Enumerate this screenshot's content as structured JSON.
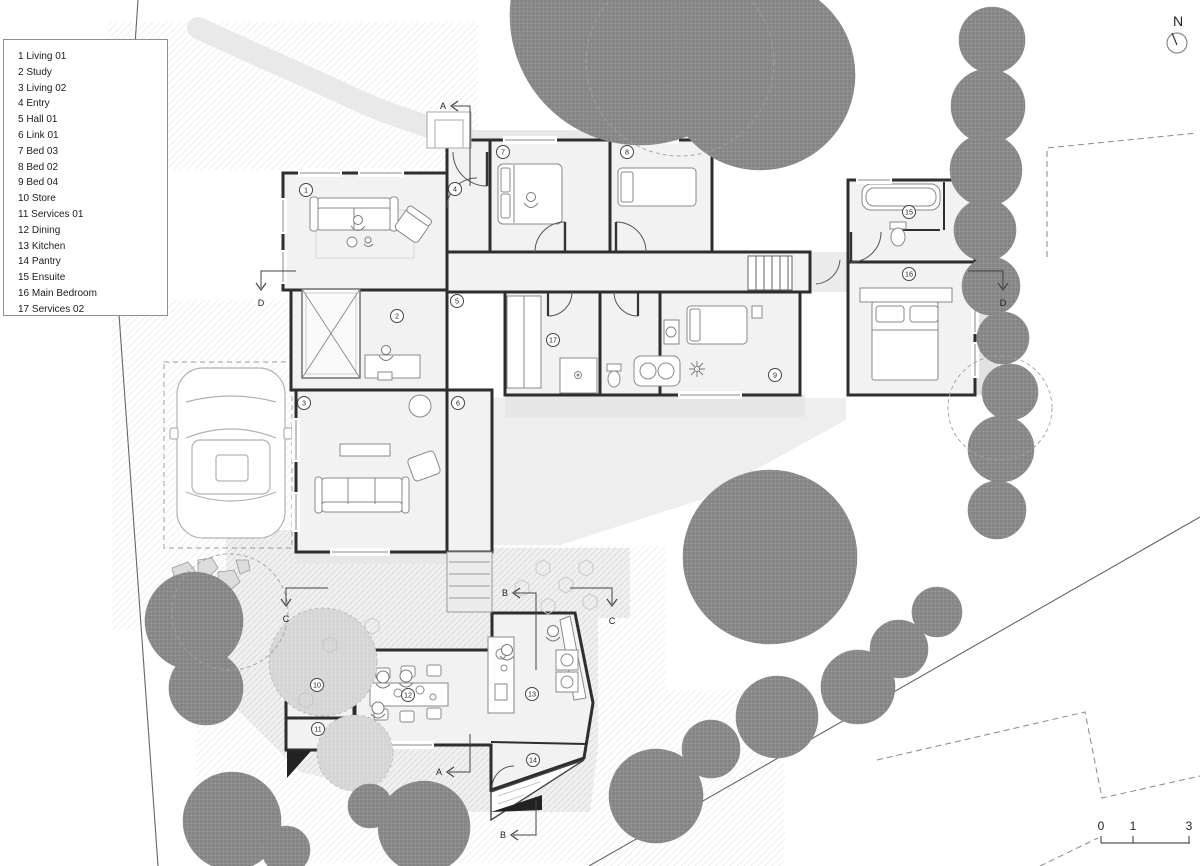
{
  "title": "Site and floor plan",
  "legend": {
    "items": [
      {
        "num": "1",
        "label": "Living 01"
      },
      {
        "num": "2",
        "label": "Study"
      },
      {
        "num": "3",
        "label": "Living 02"
      },
      {
        "num": "4",
        "label": "Entry"
      },
      {
        "num": "5",
        "label": "Hall 01"
      },
      {
        "num": "6",
        "label": "Link 01"
      },
      {
        "num": "7",
        "label": "Bed 03"
      },
      {
        "num": "8",
        "label": "Bed 02"
      },
      {
        "num": "9",
        "label": "Bed 04"
      },
      {
        "num": "10",
        "label": "Store"
      },
      {
        "num": "11",
        "label": "Services 01"
      },
      {
        "num": "12",
        "label": "Dining"
      },
      {
        "num": "13",
        "label": "Kitchen"
      },
      {
        "num": "14",
        "label": "Pantry"
      },
      {
        "num": "15",
        "label": "Ensuite"
      },
      {
        "num": "16",
        "label": "Main Bedroom"
      },
      {
        "num": "17",
        "label": "Services 02"
      }
    ]
  },
  "north": {
    "label": "N"
  },
  "scale_bar": {
    "y_line": 843,
    "x_start": 1101,
    "x_end": 1190,
    "ticks": [
      {
        "label": "0",
        "x": 1101
      },
      {
        "label": "1",
        "x": 1133
      },
      {
        "label": "3",
        "x": 1189
      }
    ]
  },
  "plan": {
    "rooms": [
      {
        "num": "1",
        "x": 306,
        "y": 190
      },
      {
        "num": "2",
        "x": 397,
        "y": 316
      },
      {
        "num": "3",
        "x": 304,
        "y": 403
      },
      {
        "num": "4",
        "x": 455,
        "y": 189
      },
      {
        "num": "5",
        "x": 457,
        "y": 301
      },
      {
        "num": "6",
        "x": 458,
        "y": 403
      },
      {
        "num": "7",
        "x": 503,
        "y": 152
      },
      {
        "num": "8",
        "x": 627,
        "y": 152
      },
      {
        "num": "9",
        "x": 775,
        "y": 375
      },
      {
        "num": "10",
        "x": 317,
        "y": 685
      },
      {
        "num": "11",
        "x": 318,
        "y": 729
      },
      {
        "num": "12",
        "x": 408,
        "y": 695
      },
      {
        "num": "13",
        "x": 532,
        "y": 694
      },
      {
        "num": "14",
        "x": 533,
        "y": 760
      },
      {
        "num": "15",
        "x": 909,
        "y": 212
      },
      {
        "num": "16",
        "x": 909,
        "y": 274
      },
      {
        "num": "17",
        "x": 553,
        "y": 340
      }
    ],
    "section_markers": [
      {
        "label": "A",
        "lx": 443,
        "ly": 109,
        "head": [
          451,
          106
        ],
        "dir": "left",
        "pts": [
          [
            453,
            106
          ],
          [
            470,
            106
          ],
          [
            470,
            186
          ]
        ]
      },
      {
        "label": "A",
        "lx": 439,
        "ly": 775,
        "head": [
          447,
          772
        ],
        "dir": "left",
        "pts": [
          [
            449,
            772
          ],
          [
            470,
            772
          ],
          [
            470,
            734
          ]
        ]
      },
      {
        "label": "B",
        "lx": 505,
        "ly": 596,
        "head": [
          513,
          593
        ],
        "dir": "left",
        "pts": [
          [
            515,
            593
          ],
          [
            536,
            593
          ],
          [
            536,
            670
          ]
        ]
      },
      {
        "label": "B",
        "lx": 503,
        "ly": 838,
        "head": [
          511,
          835
        ],
        "dir": "left",
        "pts": [
          [
            513,
            835
          ],
          [
            536,
            835
          ],
          [
            536,
            800
          ]
        ]
      },
      {
        "label": "C",
        "lx": 286,
        "ly": 622,
        "head": [
          286,
          606
        ],
        "dir": "down",
        "pts": [
          [
            286,
            604
          ],
          [
            286,
            588
          ],
          [
            328,
            588
          ]
        ]
      },
      {
        "label": "C",
        "lx": 612,
        "ly": 624,
        "head": [
          612,
          606
        ],
        "dir": "down",
        "pts": [
          [
            612,
            604
          ],
          [
            612,
            588
          ],
          [
            570,
            588
          ]
        ]
      },
      {
        "label": "D",
        "lx": 261,
        "ly": 306,
        "head": [
          261,
          290
        ],
        "dir": "down",
        "pts": [
          [
            261,
            288
          ],
          [
            261,
            271
          ],
          [
            296,
            271
          ]
        ]
      },
      {
        "label": "D",
        "lx": 1003,
        "ly": 306,
        "head": [
          1003,
          290
        ],
        "dir": "down",
        "pts": [
          [
            1003,
            288
          ],
          [
            1003,
            271
          ],
          [
            968,
            271
          ]
        ]
      }
    ]
  },
  "site": {
    "trees_dark": [
      [
        640,
        15,
        130
      ],
      [
        760,
        75,
        95
      ],
      [
        600,
        40,
        80
      ],
      [
        992,
        40,
        33
      ],
      [
        988,
        106,
        37
      ],
      [
        986,
        170,
        36
      ],
      [
        985,
        230,
        31
      ],
      [
        991,
        286,
        29
      ],
      [
        1003,
        338,
        26
      ],
      [
        1010,
        392,
        28
      ],
      [
        1001,
        449,
        33
      ],
      [
        997,
        510,
        29
      ],
      [
        770,
        557,
        87
      ],
      [
        937,
        612,
        25
      ],
      [
        899,
        649,
        29
      ],
      [
        858,
        687,
        37
      ],
      [
        777,
        717,
        41
      ],
      [
        711,
        749,
        29
      ],
      [
        656,
        796,
        47
      ],
      [
        194,
        621,
        49
      ],
      [
        206,
        688,
        37
      ],
      [
        232,
        821,
        49
      ],
      [
        424,
        827,
        46
      ],
      [
        370,
        806,
        22
      ],
      [
        286,
        850,
        24
      ]
    ],
    "trees_light": [
      [
        323,
        662,
        54
      ],
      [
        355,
        753,
        38
      ]
    ],
    "tree_outlines": [
      [
        680,
        62,
        94
      ],
      [
        1000,
        408,
        52
      ],
      [
        230,
        612,
        58
      ]
    ],
    "pavers": [
      [
        543,
        568
      ],
      [
        566,
        585
      ],
      [
        522,
        588
      ],
      [
        548,
        606
      ],
      [
        586,
        568
      ],
      [
        590,
        602
      ],
      [
        330,
        645
      ],
      [
        306,
        700
      ],
      [
        372,
        626
      ]
    ]
  }
}
